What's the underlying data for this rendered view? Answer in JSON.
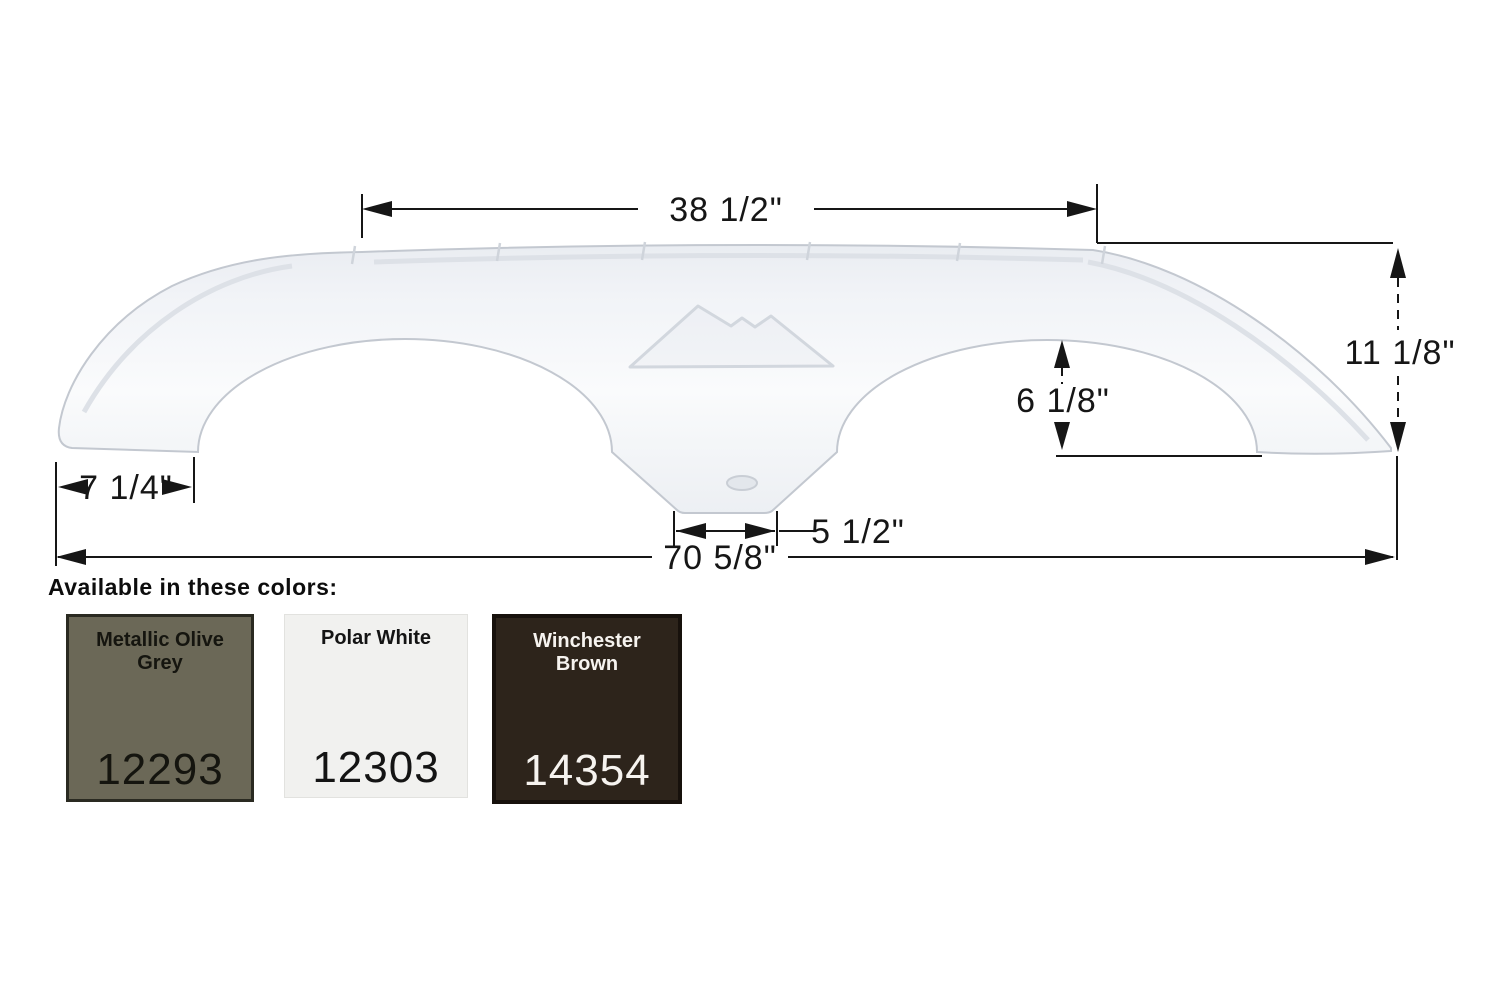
{
  "diagram": {
    "dimensions": {
      "top_width": "38 1/2\"",
      "right_height": "11 1/8\"",
      "arch_height": "6 1/8\"",
      "left_foot_width": "7 1/4\"",
      "center_tab_width": "5 1/2\"",
      "overall_width": "70 5/8\""
    },
    "fender_fill": "#f4f6f9",
    "fender_outline": "#c3c8d0",
    "dimension_line_color": "#161616"
  },
  "colors_section": {
    "heading": "Available in these colors:",
    "swatches": [
      {
        "name": "Metallic Olive Grey",
        "code": "12293",
        "fill": "#6b6857",
        "text_color": "#15150f"
      },
      {
        "name": "Polar White",
        "code": "12303",
        "fill": "#f1f1ef",
        "text_color": "#141414"
      },
      {
        "name": "Winchester Brown",
        "code": "14354",
        "fill": "#2d241b",
        "text_color": "#f6f3ef"
      }
    ]
  }
}
